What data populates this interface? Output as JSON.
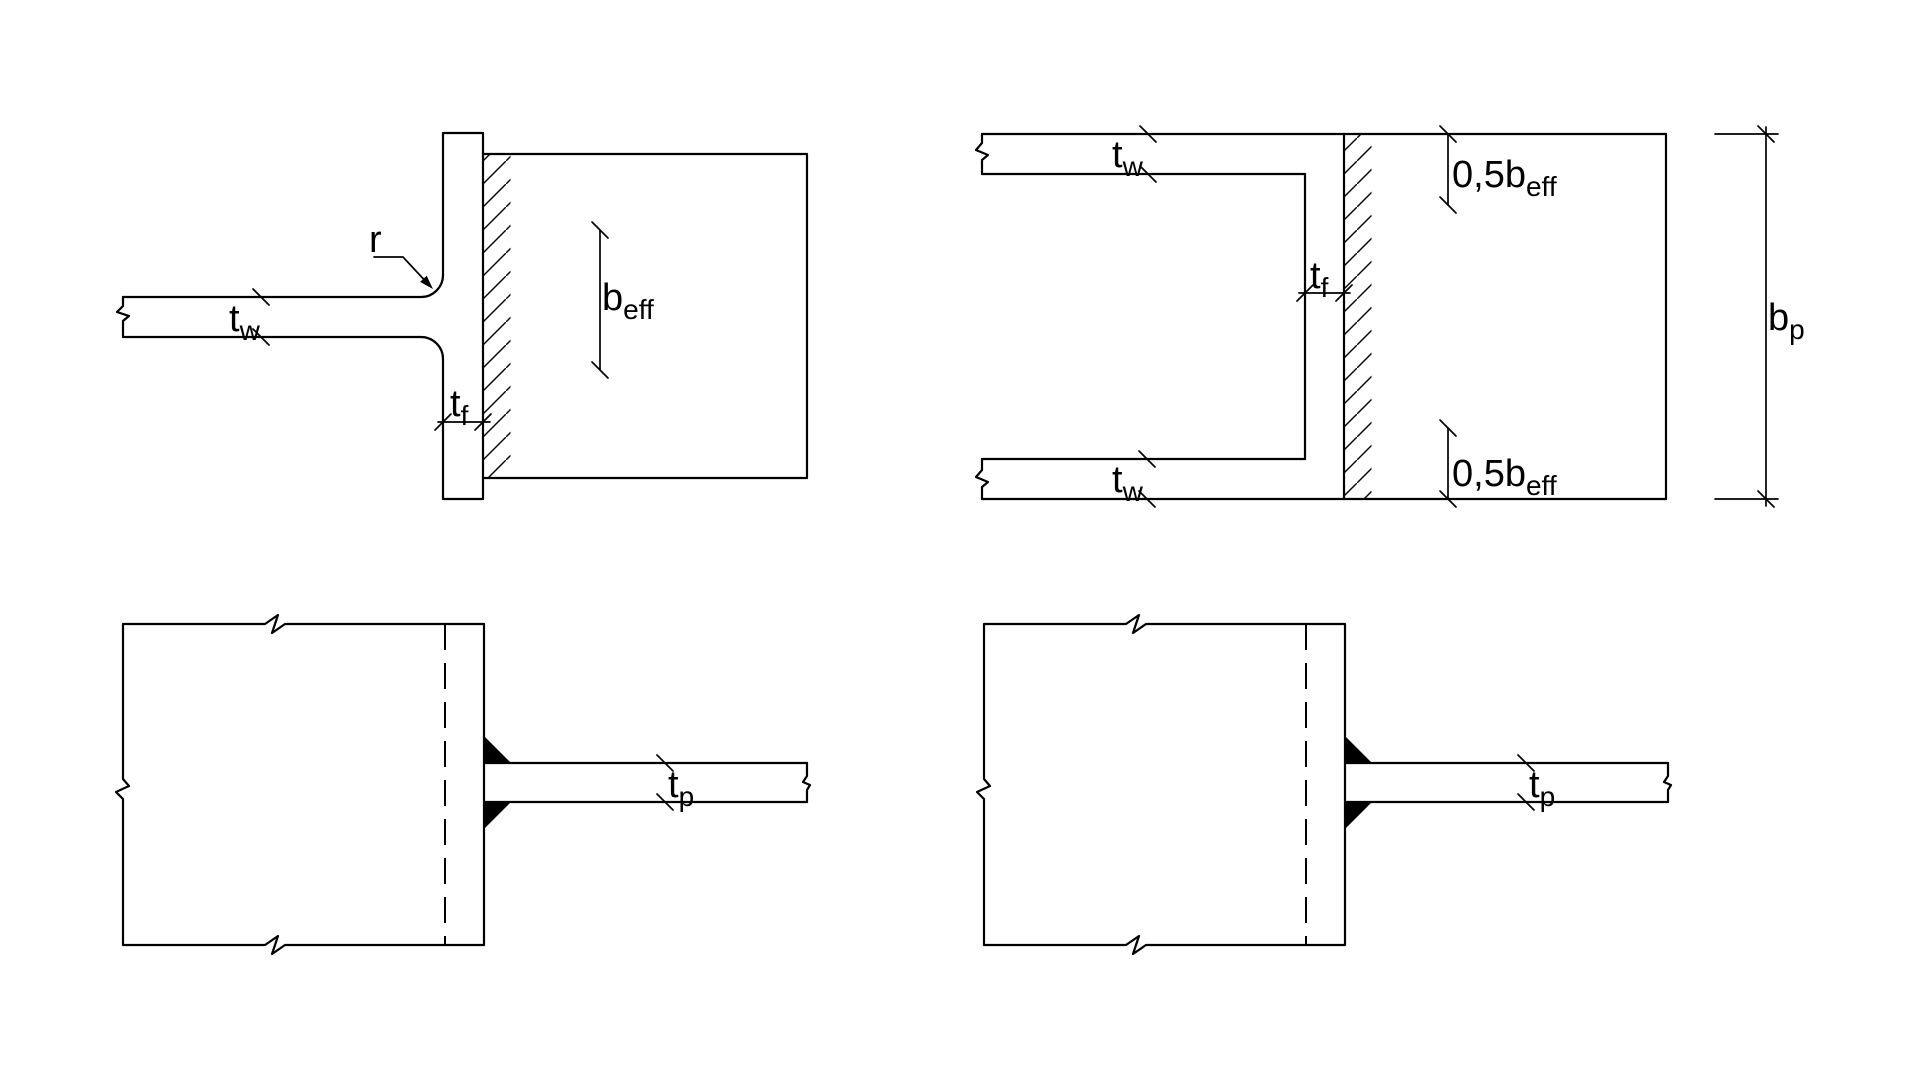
{
  "drawing": {
    "background": "#ffffff",
    "stroke_color": "#000000",
    "figures": {
      "i_section_weld": {
        "labels": {
          "radius": {
            "main": "r",
            "sub": ""
          },
          "web_thickness": {
            "main": "t",
            "sub": "w"
          },
          "flange_thickness": {
            "main": "t",
            "sub": "f"
          },
          "effective_width": {
            "main": "b",
            "sub": "eff"
          }
        }
      },
      "rhs_section_weld": {
        "labels": {
          "web_thickness_top": {
            "main": "t",
            "sub": "w"
          },
          "web_thickness_bottom": {
            "main": "t",
            "sub": "w"
          },
          "flange_thickness": {
            "main": "t",
            "sub": "f"
          },
          "half_effective_width_top": {
            "main": "0,5b",
            "sub": "eff"
          },
          "half_effective_width_bottom": {
            "main": "0,5b",
            "sub": "eff"
          },
          "plate_width": {
            "main": "b",
            "sub": "p"
          }
        }
      },
      "plate_fillet_weld_left": {
        "labels": {
          "plate_thickness": {
            "main": "t",
            "sub": "p"
          }
        }
      },
      "plate_fillet_weld_right": {
        "labels": {
          "plate_thickness": {
            "main": "t",
            "sub": "p"
          }
        }
      }
    }
  }
}
